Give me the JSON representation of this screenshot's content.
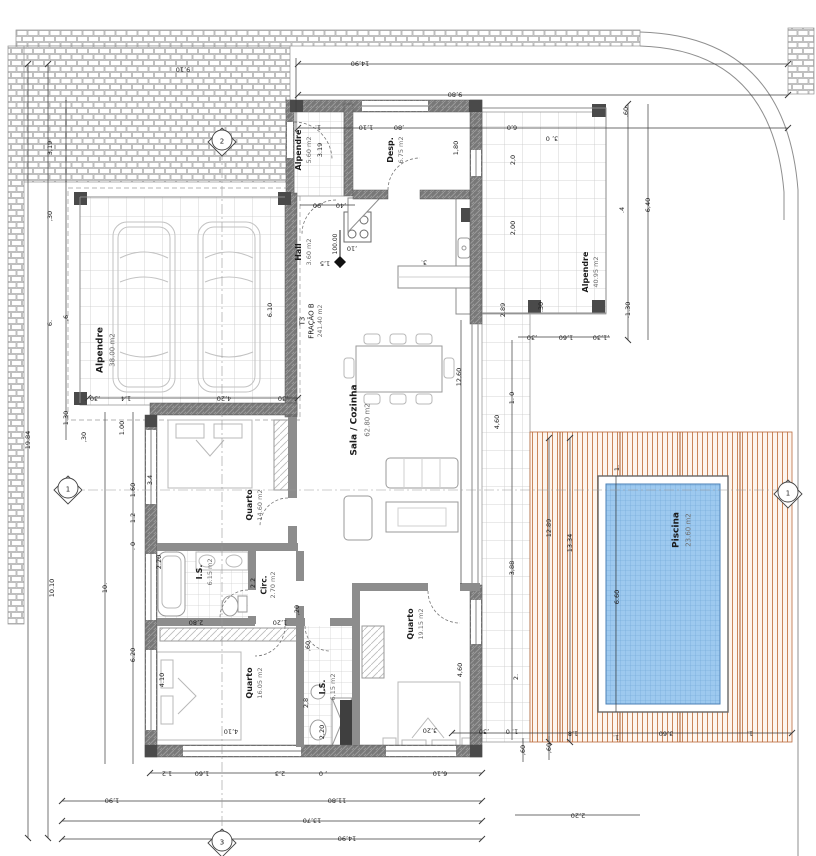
{
  "sheet": {
    "type": "architectural floor plan",
    "fraction_code": "T3",
    "fraction_name": "FRAÇÃO B",
    "fraction_area": "241.40 m2",
    "level": "100.00"
  },
  "colors": {
    "pool_water": "#9dc9ef",
    "pool_grid": "#6ea6d6",
    "deck_wood": "#b96a3c",
    "wall_fill": "#787878",
    "tile_line": "#c9c9c9",
    "brick_line": "#a8a8a8",
    "dim_line": "#3c3c3c"
  },
  "rooms": [
    {
      "name": "Alpendre",
      "area": "38.00 m2"
    },
    {
      "name": "Alpendre",
      "area": "5.60 m2"
    },
    {
      "name": "Desp.",
      "area": "6.75 m2"
    },
    {
      "name": "Hall",
      "area": "3.60 m2"
    },
    {
      "name": "Sala / Cozinha",
      "area": "62.80 m2"
    },
    {
      "name": "Quarto",
      "area": "14.60 m2"
    },
    {
      "name": "I.S.",
      "area": "6.15 m2"
    },
    {
      "name": "Circ.",
      "area": "2.70 m2"
    },
    {
      "name": "Quarto",
      "area": "16.05 m2"
    },
    {
      "name": "I.S.",
      "area": "6,15 m2"
    },
    {
      "name": "Quarto",
      "area": "19.15 m2"
    },
    {
      "name": "Alpendre",
      "area": "40.95 m2"
    },
    {
      "name": "Piscina",
      "area": "23.60 m2"
    }
  ],
  "markers": {
    "axis_labels": [
      "1",
      "2",
      "3"
    ],
    "level_mark": "100.00"
  },
  "labels": [
    {
      "t": "Alpendre",
      "x": 101,
      "y": 350,
      "r": -90,
      "s": 9,
      "b": 1,
      "n": "room-label-carport"
    },
    {
      "t": "38.00 m2",
      "x": 113,
      "y": 350,
      "r": -90,
      "s": 7,
      "c": "g",
      "n": "room-area-carport"
    },
    {
      "t": "Alpendre",
      "x": 299,
      "y": 150,
      "r": -90,
      "s": 8,
      "b": 1,
      "n": "room-label-porch-north"
    },
    {
      "t": "5.60 m2",
      "x": 309,
      "y": 150,
      "r": -90,
      "s": 6.5,
      "c": "g",
      "n": "room-area-porch-north"
    },
    {
      "t": "3.19",
      "x": 320,
      "y": 150,
      "r": -90,
      "s": 6.5,
      "n": "dim-label"
    },
    {
      "t": "Desp.",
      "x": 391,
      "y": 150,
      "r": -90,
      "s": 8,
      "b": 1,
      "n": "room-label-pantry"
    },
    {
      "t": "6.75 m2",
      "x": 401,
      "y": 150,
      "r": -90,
      "s": 6.5,
      "c": "g",
      "n": "room-area-pantry"
    },
    {
      "t": "Hall",
      "x": 299,
      "y": 252,
      "r": -90,
      "s": 8,
      "b": 1,
      "n": "room-label-hall"
    },
    {
      "t": "3.60 m2",
      "x": 309,
      "y": 252,
      "r": -90,
      "s": 6.5,
      "c": "g",
      "n": "room-area-hall"
    },
    {
      "t": "1,5",
      "x": 325,
      "y": 263,
      "r": 180,
      "s": 6.5,
      "n": "dim-label"
    },
    {
      "t": "100.00",
      "x": 336,
      "y": 244,
      "r": -90,
      "s": 6,
      "n": "level-label"
    },
    {
      "t": "T3",
      "x": 303,
      "y": 321,
      "r": -90,
      "s": 7,
      "n": "fraction-code"
    },
    {
      "t": "FRAÇÃO B",
      "x": 312,
      "y": 321,
      "r": -90,
      "s": 7,
      "n": "fraction-name"
    },
    {
      "t": "241.40 m2",
      "x": 321,
      "y": 321,
      "r": -90,
      "s": 6,
      "c": "g",
      "n": "fraction-area"
    },
    {
      "t": "Sala / Cozinha",
      "x": 355,
      "y": 420,
      "r": -90,
      "s": 9,
      "b": 1,
      "n": "room-label-living-kitchen"
    },
    {
      "t": "62.80 m2",
      "x": 368,
      "y": 420,
      "r": -90,
      "s": 7,
      "c": "g",
      "n": "room-area-living-kitchen"
    },
    {
      "t": "Quarto",
      "x": 250,
      "y": 505,
      "r": -90,
      "s": 8,
      "b": 1,
      "n": "room-label-bedroom-1"
    },
    {
      "t": "14.60 m2",
      "x": 260,
      "y": 505,
      "r": -90,
      "s": 6.5,
      "c": "g",
      "n": "room-area-bedroom-1"
    },
    {
      "t": "I.S.",
      "x": 200,
      "y": 572,
      "r": -90,
      "s": 8,
      "b": 1,
      "n": "room-label-bath-1"
    },
    {
      "t": "6.15 m2",
      "x": 210,
      "y": 572,
      "r": -90,
      "s": 6.5,
      "c": "g",
      "n": "room-area-bath-1"
    },
    {
      "t": "Circ.",
      "x": 264,
      "y": 585,
      "r": -90,
      "s": 7.5,
      "b": 1,
      "n": "room-label-circulation"
    },
    {
      "t": "2.70 m2",
      "x": 273,
      "y": 585,
      "r": -90,
      "s": 6.5,
      "c": "g",
      "n": "room-area-circulation"
    },
    {
      "t": "2.2",
      "x": 253,
      "y": 583,
      "r": -90,
      "s": 6.5,
      "n": "dim-label"
    },
    {
      "t": "Quarto",
      "x": 250,
      "y": 683,
      "r": -90,
      "s": 8,
      "b": 1,
      "n": "room-label-bedroom-2"
    },
    {
      "t": "16.05 m2",
      "x": 260,
      "y": 683,
      "r": -90,
      "s": 6.5,
      "c": "g",
      "n": "room-area-bedroom-2"
    },
    {
      "t": "I.S.",
      "x": 323,
      "y": 687,
      "r": -90,
      "s": 8,
      "b": 1,
      "n": "room-label-bath-2"
    },
    {
      "t": "6,15 m2",
      "x": 333,
      "y": 687,
      "r": -90,
      "s": 6.5,
      "c": "g",
      "n": "room-area-bath-2"
    },
    {
      "t": "Quarto",
      "x": 411,
      "y": 624,
      "r": -90,
      "s": 8,
      "b": 1,
      "n": "room-label-bedroom-3"
    },
    {
      "t": "19.15 m2",
      "x": 421,
      "y": 624,
      "r": -90,
      "s": 6.5,
      "c": "g",
      "n": "room-area-bedroom-3"
    },
    {
      "t": "Alpendre",
      "x": 586,
      "y": 272,
      "r": -90,
      "s": 8,
      "b": 1,
      "n": "room-label-porch-east"
    },
    {
      "t": "40.95 m2",
      "x": 596,
      "y": 272,
      "r": -90,
      "s": 6.5,
      "c": "g",
      "n": "room-area-porch-east"
    },
    {
      "t": "Piscina",
      "x": 677,
      "y": 530,
      "r": -90,
      "s": 9,
      "b": 1,
      "n": "room-label-pool"
    },
    {
      "t": "23.60 m2",
      "x": 689,
      "y": 530,
      "r": -90,
      "s": 7,
      "c": "g",
      "n": "room-area-pool"
    },
    {
      "t": "14,90",
      "x": 360,
      "y": 63,
      "r": 180,
      "s": 6.5,
      "n": "dim-label"
    },
    {
      "t": "9,80",
      "x": 455,
      "y": 94,
      "r": 180,
      "s": 6.5,
      "n": "dim-label"
    },
    {
      "t": "1.",
      "x": 318,
      "y": 127,
      "r": 180,
      "s": 6.5,
      "n": "dim-label"
    },
    {
      "t": "1,10",
      "x": 366,
      "y": 127,
      "r": 180,
      "s": 6.5,
      "n": "dim-label"
    },
    {
      "t": ",80",
      "x": 399,
      "y": 127,
      "r": 180,
      "s": 6.5,
      "n": "dim-label"
    },
    {
      "t": "6,0",
      "x": 512,
      "y": 127,
      "r": 180,
      "s": 6.5,
      "n": "dim-label"
    },
    {
      "t": "9,10",
      "x": 183,
      "y": 69,
      "r": 180,
      "s": 6.5,
      "n": "dim-label"
    },
    {
      "t": ".60",
      "x": 626,
      "y": 112,
      "r": -90,
      "s": 6.5,
      "n": "dim-label"
    },
    {
      "t": "3, 0",
      "x": 552,
      "y": 138,
      "r": 180,
      "s": 6.5,
      "n": "dim-label"
    },
    {
      "t": "2,0",
      "x": 513,
      "y": 160,
      "r": -90,
      "s": 6.5,
      "n": "dim-label"
    },
    {
      "t": "2,00",
      "x": 513,
      "y": 228,
      "r": -90,
      "s": 6.5,
      "n": "dim-label"
    },
    {
      "t": "1,80",
      "x": 456,
      "y": 148,
      "r": -90,
      "s": 6.5,
      "n": "dim-label"
    },
    {
      "t": ".4",
      "x": 622,
      "y": 210,
      "r": -90,
      "s": 6.5,
      "n": "dim-label"
    },
    {
      "t": "6,40",
      "x": 648,
      "y": 205,
      "r": -90,
      "s": 6.5,
      "n": "dim-label"
    },
    {
      "t": "-1.30",
      "x": 628,
      "y": 310,
      "r": -90,
      "s": 6.5,
      "n": "dim-label"
    },
    {
      "t": "2.89",
      "x": 503,
      "y": 310,
      "r": -90,
      "s": 6.5,
      "n": "dim-label"
    },
    {
      "t": ".30",
      "x": 541,
      "y": 307,
      "r": -90,
      "s": 6.5,
      "n": "dim-label"
    },
    {
      "t": ",30",
      "x": 532,
      "y": 337,
      "r": 180,
      "s": 6.5,
      "n": "dim-label"
    },
    {
      "t": "1,60",
      "x": 566,
      "y": 337,
      "r": 180,
      "s": 6.5,
      "n": "dim-label"
    },
    {
      "t": ",1,30",
      "x": 601,
      "y": 337,
      "r": 180,
      "s": 6.5,
      "n": "dim-label"
    },
    {
      "t": "3,19",
      "x": 50,
      "y": 148,
      "r": -90,
      "s": 6.5,
      "n": "dim-label"
    },
    {
      "t": ",30",
      "x": 50,
      "y": 216,
      "r": -90,
      "s": 6.5,
      "n": "dim-label"
    },
    {
      "t": "6.",
      "x": 50,
      "y": 323,
      "r": -90,
      "s": 6.5,
      "n": "dim-label"
    },
    {
      "t": ",6",
      "x": 66,
      "y": 318,
      "r": -90,
      "s": 6.5,
      "n": "dim-label"
    },
    {
      "t": "19.84",
      "x": 28,
      "y": 440,
      "r": -90,
      "s": 6.5,
      "n": "dim-label"
    },
    {
      "t": "10.10",
      "x": 52,
      "y": 588,
      "r": -90,
      "s": 6.5,
      "n": "dim-label"
    },
    {
      "t": "10.",
      "x": 105,
      "y": 588,
      "r": -90,
      "s": 6.5,
      "n": "dim-label"
    },
    {
      "t": "1.30",
      "x": 66,
      "y": 418,
      "r": -90,
      "s": 6.5,
      "n": "dim-label"
    },
    {
      "t": ",30",
      "x": 84,
      "y": 437,
      "r": -90,
      "s": 6.5,
      "n": "dim-label"
    },
    {
      "t": "1.00",
      "x": 122,
      "y": 428,
      "r": -90,
      "s": 6.5,
      "n": "dim-label"
    },
    {
      "t": "1.60",
      "x": 133,
      "y": 490,
      "r": -90,
      "s": 6.5,
      "n": "dim-label"
    },
    {
      "t": "3.4",
      "x": 150,
      "y": 480,
      "r": -90,
      "s": 6.5,
      "n": "dim-label"
    },
    {
      "t": "1.2",
      "x": 133,
      "y": 518,
      "r": -90,
      "s": 6.5,
      "n": "dim-label"
    },
    {
      "t": ". 0",
      "x": 133,
      "y": 546,
      "r": -90,
      "s": 6.5,
      "n": "dim-label"
    },
    {
      "t": "2.20",
      "x": 159,
      "y": 562,
      "r": -90,
      "s": 6.5,
      "n": "dim-label"
    },
    {
      "t": "6.20",
      "x": 133,
      "y": 655,
      "r": -90,
      "s": 6.5,
      "n": "dim-label"
    },
    {
      "t": "4.10",
      "x": 162,
      "y": 680,
      "r": -90,
      "s": 6.5,
      "n": "dim-label"
    },
    {
      "t": "6.10",
      "x": 270,
      "y": 310,
      "r": -90,
      "s": 6.5,
      "n": "dim-label"
    },
    {
      "t": "4,20",
      "x": 224,
      "y": 398,
      "r": 180,
      "s": 6.5,
      "n": "dim-label"
    },
    {
      "t": "1,4",
      "x": 126,
      "y": 398,
      "r": 180,
      "s": 6.5,
      "n": "dim-label"
    },
    {
      "t": ",30",
      "x": 95,
      "y": 398,
      "r": 180,
      "s": 6.5,
      "n": "dim-label"
    },
    {
      "t": ",30",
      "x": 283,
      "y": 398,
      "r": 180,
      "s": 6.5,
      "n": "dim-label"
    },
    {
      "t": ",90",
      "x": 318,
      "y": 205,
      "r": 180,
      "s": 6.5,
      "n": "dim-label"
    },
    {
      "t": ",40",
      "x": 341,
      "y": 205,
      "r": 180,
      "s": 6.5,
      "n": "dim-label"
    },
    {
      "t": ",10",
      "x": 352,
      "y": 248,
      "r": 180,
      "s": 6.5,
      "n": "dim-label"
    },
    {
      "t": "3.",
      "x": 424,
      "y": 262,
      "r": 180,
      "s": 6.5,
      "n": "dim-label"
    },
    {
      "t": "12,60",
      "x": 459,
      "y": 377,
      "r": -90,
      "s": 6.5,
      "n": "dim-label"
    },
    {
      "t": "3,88",
      "x": 512,
      "y": 568,
      "r": -90,
      "s": 6.5,
      "n": "dim-label"
    },
    {
      "t": "4,60",
      "x": 497,
      "y": 422,
      "r": -90,
      "s": 6.5,
      "n": "dim-label"
    },
    {
      "t": "1. 0",
      "x": 512,
      "y": 398,
      "r": -90,
      "s": 6.5,
      "n": "dim-label"
    },
    {
      "t": "2.",
      "x": 516,
      "y": 677,
      "r": -90,
      "s": 6.5,
      "n": "dim-label"
    },
    {
      "t": "12.89",
      "x": 549,
      "y": 528,
      "r": -90,
      "s": 6.5,
      "n": "dim-label"
    },
    {
      "t": "13.34",
      "x": 570,
      "y": 543,
      "r": -90,
      "s": 6.5,
      "n": "dim-label"
    },
    {
      "t": "6.60",
      "x": 617,
      "y": 597,
      "r": -90,
      "s": 6.5,
      "n": "dim-label"
    },
    {
      "t": "1.",
      "x": 617,
      "y": 468,
      "r": -90,
      "s": 6.5,
      "n": "dim-label"
    },
    {
      "t": ",30",
      "x": 484,
      "y": 731,
      "r": 180,
      "s": 6.5,
      "n": "dim-label"
    },
    {
      "t": "1. 0",
      "x": 512,
      "y": 731,
      "r": 180,
      "s": 6.5,
      "n": "dim-label"
    },
    {
      "t": ",60",
      "x": 523,
      "y": 750,
      "r": -90,
      "s": 6.5,
      "n": "dim-label"
    },
    {
      "t": ",60",
      "x": 549,
      "y": 748,
      "r": -90,
      "s": 6.5,
      "n": "dim-label"
    },
    {
      "t": "1,8",
      "x": 573,
      "y": 733,
      "r": 180,
      "s": 6.5,
      "n": "dim-label"
    },
    {
      "t": "1.",
      "x": 616,
      "y": 737,
      "r": 180,
      "s": 6.5,
      "n": "dim-label"
    },
    {
      "t": "3,60",
      "x": 666,
      "y": 733,
      "r": 180,
      "s": 6.5,
      "n": "dim-label"
    },
    {
      "t": "1.",
      "x": 750,
      "y": 733,
      "r": 180,
      "s": 6.5,
      "n": "dim-label"
    },
    {
      "t": "2,20",
      "x": 578,
      "y": 815,
      "r": 180,
      "s": 6.5,
      "n": "dim-label"
    },
    {
      "t": "4,10",
      "x": 231,
      "y": 731,
      "r": 180,
      "s": 6.5,
      "n": "dim-label"
    },
    {
      "t": "3,20",
      "x": 430,
      "y": 730,
      "r": 180,
      "s": 6.5,
      "n": "dim-label"
    },
    {
      "t": "2,80",
      "x": 196,
      "y": 622,
      "r": 180,
      "s": 6.5,
      "n": "dim-label"
    },
    {
      "t": "1,20",
      "x": 280,
      "y": 622,
      "r": 180,
      "s": 6.5,
      "n": "dim-label"
    },
    {
      "t": "2,20",
      "x": 322,
      "y": 732,
      "r": -90,
      "s": 6.5,
      "n": "dim-label"
    },
    {
      "t": ",60",
      "x": 308,
      "y": 646,
      "r": -90,
      "s": 6.5,
      "n": "dim-label"
    },
    {
      "t": "2,8",
      "x": 306,
      "y": 703,
      "r": -90,
      "s": 6.5,
      "n": "dim-label"
    },
    {
      "t": ",20",
      "x": 297,
      "y": 610,
      "r": -90,
      "s": 6.5,
      "n": "dim-label"
    },
    {
      "t": "4,60",
      "x": 460,
      "y": 670,
      "r": -90,
      "s": 6.5,
      "n": "dim-label"
    },
    {
      "t": "1.2",
      "x": 167,
      "y": 773,
      "r": 180,
      "s": 6.5,
      "n": "dim-label"
    },
    {
      "t": "1,60",
      "x": 202,
      "y": 773,
      "r": 180,
      "s": 6.5,
      "n": "dim-label"
    },
    {
      "t": "2,3",
      "x": 280,
      "y": 773,
      "r": 180,
      "s": 6.5,
      "n": "dim-label"
    },
    {
      "t": ", 0",
      "x": 323,
      "y": 773,
      "r": 180,
      "s": 6.5,
      "n": "dim-label"
    },
    {
      "t": "6,10",
      "x": 440,
      "y": 773,
      "r": 180,
      "s": 6.5,
      "n": "dim-label"
    },
    {
      "t": "1,90",
      "x": 112,
      "y": 800,
      "r": 180,
      "s": 6.5,
      "n": "dim-label"
    },
    {
      "t": "11,80",
      "x": 337,
      "y": 800,
      "r": 180,
      "s": 6.5,
      "n": "dim-label"
    },
    {
      "t": "13,70",
      "x": 312,
      "y": 820,
      "r": 180,
      "s": 6.5,
      "n": "dim-label"
    },
    {
      "t": "14,90",
      "x": 347,
      "y": 838,
      "r": 180,
      "s": 6.5,
      "n": "dim-label"
    },
    {
      "t": "2",
      "x": 222,
      "y": 142,
      "s": 7,
      "n": "axis-marker-2-label"
    },
    {
      "t": "1",
      "x": 68,
      "y": 490,
      "s": 7,
      "n": "axis-marker-1-left-label"
    },
    {
      "t": "1",
      "x": 788,
      "y": 494,
      "s": 7,
      "n": "axis-marker-1-right-label"
    },
    {
      "t": "3",
      "x": 222,
      "y": 843,
      "s": 7,
      "n": "axis-marker-3-label"
    }
  ]
}
